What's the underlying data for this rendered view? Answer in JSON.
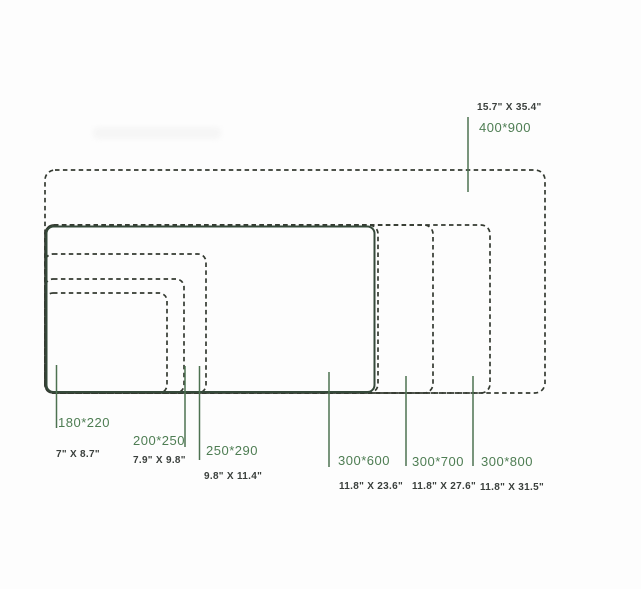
{
  "sizes": [
    {
      "mm": "180*220",
      "inch": "7\" X 8.7\""
    },
    {
      "mm": "200*250",
      "inch": "7.9\" X 9.8\""
    },
    {
      "mm": "250*290",
      "inch": "9.8\" X 11.4\""
    },
    {
      "mm": "300*600",
      "inch": "11.8\" X 23.6\""
    },
    {
      "mm": "300*700",
      "inch": "11.8\" X 27.6\""
    },
    {
      "mm": "300*800",
      "inch": "11.8\" X 31.5\""
    },
    {
      "mm": "400*900",
      "inch": "15.7\" X 35.4\""
    }
  ],
  "colors": {
    "dashed_outline": "#343a31",
    "solid_outline": "#35493a",
    "leader_line": "#4d7251",
    "mm_label": "#4e7d53",
    "inch_label": "#3a3f3c",
    "background": "#fdfdfd"
  }
}
